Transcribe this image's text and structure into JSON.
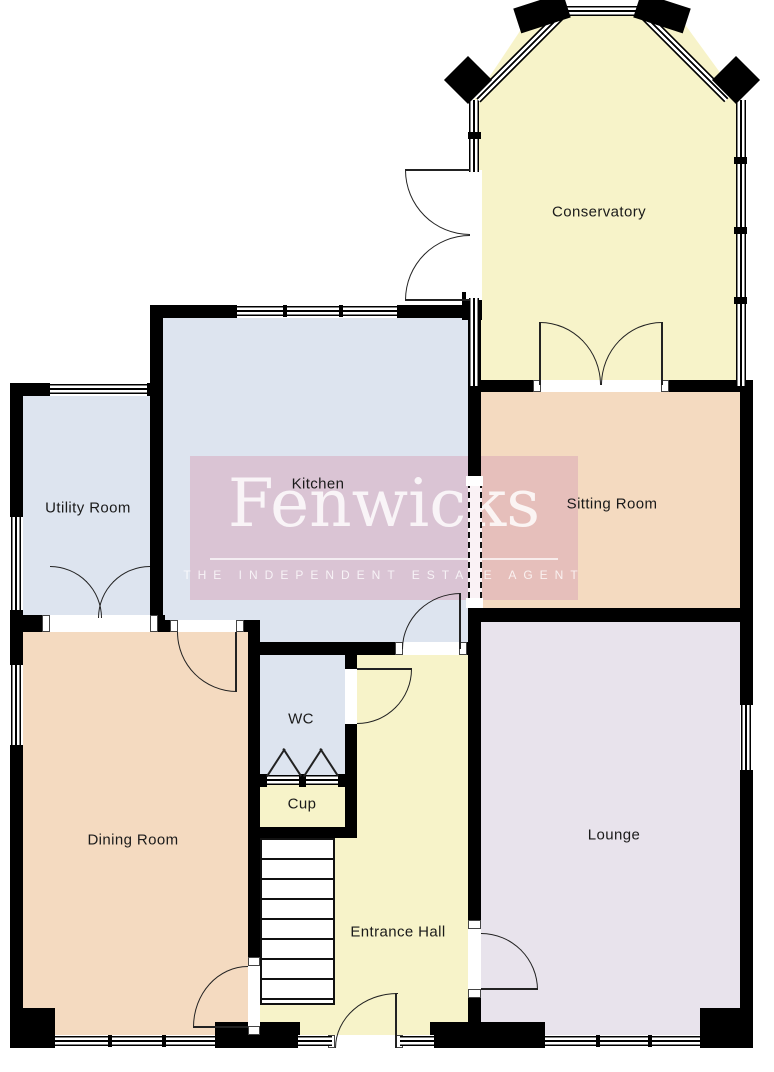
{
  "watermark": {
    "name": "Fenwicks",
    "tagline": "THE INDEPENDENT ESTATE AGENT"
  },
  "rooms": {
    "conservatory": "Conservatory",
    "kitchen": "Kitchen",
    "utility_room": "Utility Room",
    "sitting_room": "Sitting Room",
    "dining_room": "Dining Room",
    "wc": "WC",
    "cupboard": "Cup",
    "entrance_hall": "Entrance Hall",
    "lounge": "Lounge"
  },
  "colors": {
    "room-yellow": "#f7f3c9",
    "room-blue": "#dde4ef",
    "room-peach": "#f4dac0",
    "room-lavender": "#e8e3ec",
    "wall": "#000000"
  }
}
